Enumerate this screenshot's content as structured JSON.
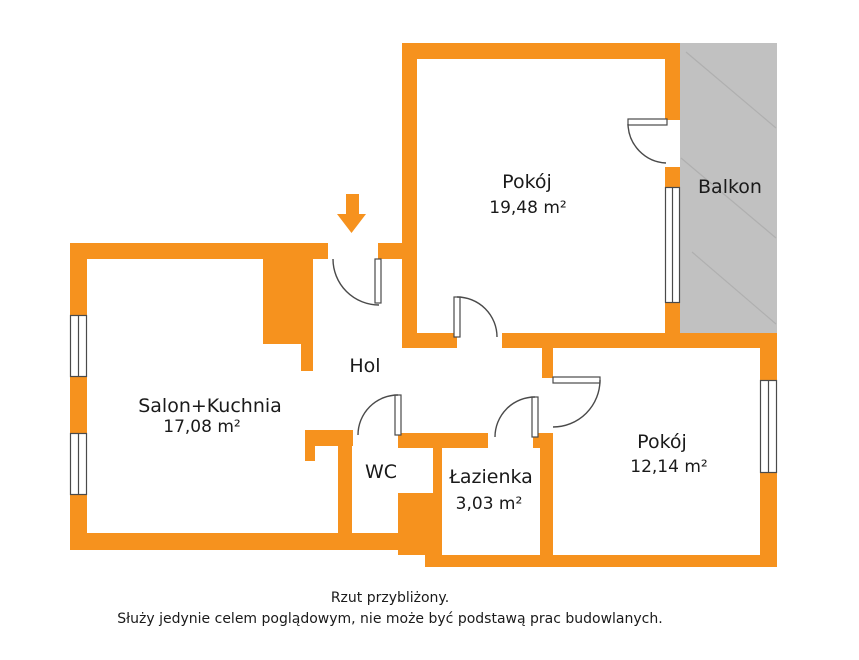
{
  "colors": {
    "wall": "#F6921E",
    "balcony": "#C1C1C1",
    "balcony_hatch": "#AFAFAF",
    "line": "#4A4A4A",
    "text": "#1A1A1A"
  },
  "rooms": [
    {
      "id": "pokoj-gorny",
      "name": "Pokój",
      "area": "19,48 m²"
    },
    {
      "id": "balkon",
      "name": "Balkon",
      "area": ""
    },
    {
      "id": "salon-kuchnia",
      "name": "Salon+Kuchnia",
      "area": "17,08 m²"
    },
    {
      "id": "hol",
      "name": "Hol",
      "area": ""
    },
    {
      "id": "wc",
      "name": "WC",
      "area": ""
    },
    {
      "id": "lazienka",
      "name": "Łazienka",
      "area": "3,03 m²"
    },
    {
      "id": "pokoj-dolny",
      "name": "Pokój",
      "area": "12,14 m²"
    }
  ],
  "footer": {
    "line1": "Rzut przybliżony.",
    "line2": "Służy jedynie celem poglądowym, nie może być podstawą prac budowlanych."
  }
}
